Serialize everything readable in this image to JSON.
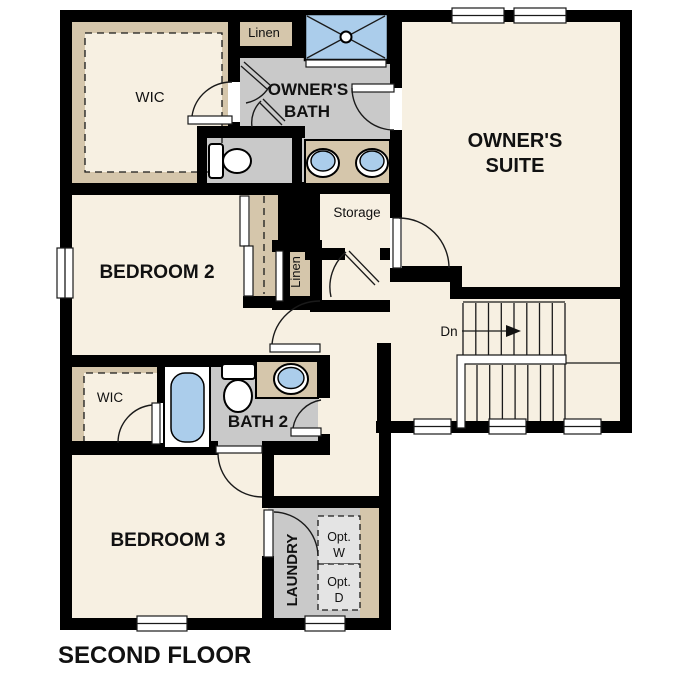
{
  "colors": {
    "wall": "#000000",
    "line": "#1a1a1a",
    "floor": "#f7f0e2",
    "tan": "#d5c6ab",
    "gray": "#c9c9c9",
    "gray_light": "#e4e4e4",
    "blue": "#abcdeb",
    "white": "#ffffff"
  },
  "labels": {
    "wic_owner": "WIC",
    "linen_top": "Linen",
    "owners_bath_1": "OWNER'S",
    "owners_bath_2": "BATH",
    "owners_suite_1": "OWNER'S",
    "owners_suite_2": "SUITE",
    "storage": "Storage",
    "bedroom2": "BEDROOM 2",
    "linen_hall": "Linen",
    "dn": "Dn",
    "wic2": "WIC",
    "bath2": "BATH 2",
    "bedroom3": "BEDROOM 3",
    "laundry": "LAUNDRY",
    "opt_w_1": "Opt.",
    "opt_w_2": "W",
    "opt_d_1": "Opt.",
    "opt_d_2": "D",
    "title": "SECOND FLOOR"
  }
}
